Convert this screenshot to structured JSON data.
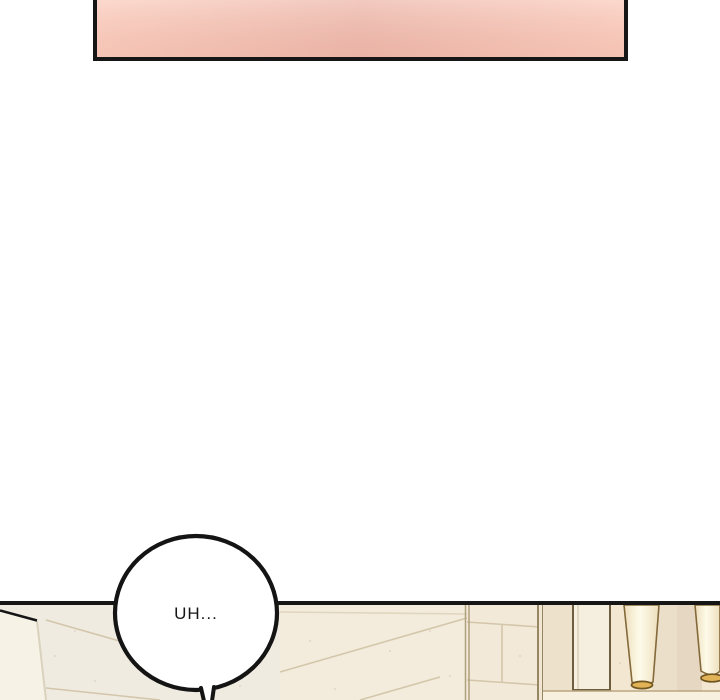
{
  "comic": {
    "description": "webtoon page transition: cropped pink panel top, white gutter, speech bubble, top edge of interior panel below",
    "ink": "#161616",
    "page_bg": "#ffffff",
    "top_panel": {
      "fill_left": "#fbccbd",
      "fill_center": "#eeb8ab",
      "fill_right": "#fbcbbc",
      "border": "#161616"
    },
    "speech_bubble": {
      "text": "UH...",
      "fill": "#ffffff",
      "stroke": "#141414",
      "text_color": "#161616"
    },
    "bottom_scene": {
      "border": "#161616",
      "wall_left": "#efebe0",
      "wall_warm": "#f6ecd9",
      "wall_mid": "#f3e9d8",
      "wall_right": "#f3e7d2",
      "grout": "#d3c6ab",
      "corner_line": "#b0a07c",
      "edge_line_dark": "#8d7c58",
      "between_corner_fill": "#f0e6d2",
      "tan_strip": "#eee1cb",
      "frame_fill": "#f5efdf",
      "frame_line": "#6e5e40",
      "frame_inner_line": "#cfc2a6",
      "band_soft": "#ecdfca",
      "band_shadow": "#e5d7c1",
      "ledge_fill": "#f7f0de",
      "ledge_line": "#b9a67f",
      "door_fill": "#f6f2e6",
      "door_edge": "#d9d2bd",
      "lamp_shade_edge": "#eddebc",
      "lamp_shade_center": "#fefbea",
      "lamp_outline": "#84693a",
      "lamp_rim_fill": "#e2b257",
      "lamp_rim_stroke": "#6f5520",
      "speckle": "#d8d0bc"
    }
  }
}
